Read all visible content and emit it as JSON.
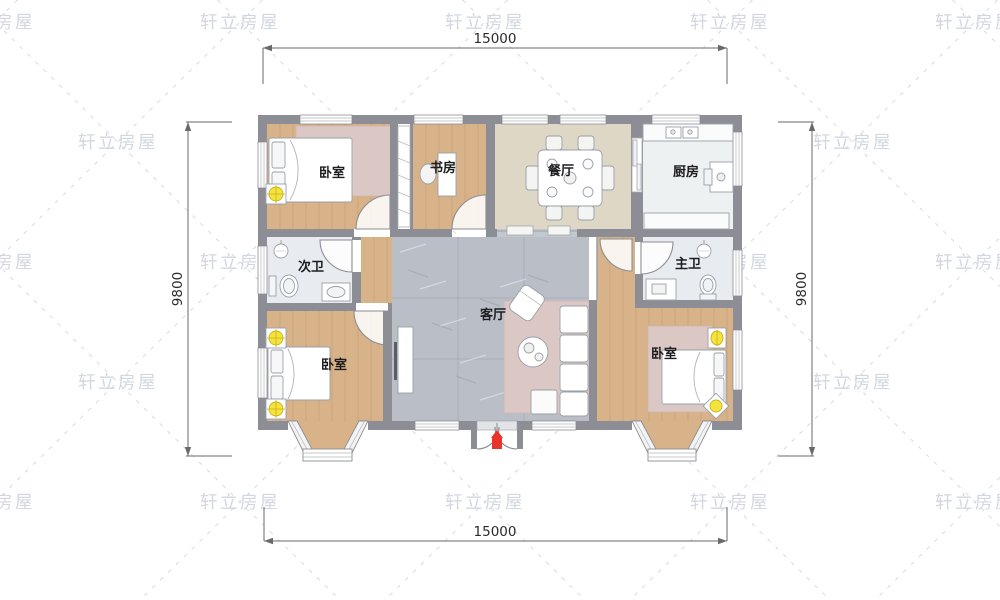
{
  "watermark": {
    "text": "轩立房屋",
    "color": "#c9d2dd"
  },
  "dimensions": {
    "top": "15000",
    "bottom": "15000",
    "left": "9800",
    "right": "9800"
  },
  "rooms": {
    "bedroom_top_left": {
      "label": "卧室"
    },
    "study": {
      "label": "书房"
    },
    "dining": {
      "label": "餐厅"
    },
    "kitchen": {
      "label": "厨房"
    },
    "bath_secondary": {
      "label": "次卫"
    },
    "bath_master": {
      "label": "主卫"
    },
    "living": {
      "label": "客厅"
    },
    "bedroom_bottom_left": {
      "label": "卧室"
    },
    "bedroom_bottom_right": {
      "label": "卧室"
    }
  },
  "colors": {
    "wall": "#8d8d95",
    "wood_floor": "#d8b289",
    "dining_floor": "#ded7c5",
    "kitchen_floor": "#eef1f2",
    "bath_floor": "#e8ecf1",
    "living_floor": "#b9bec7",
    "rug": "#dbc8c4",
    "lamp_yellow": "#f5e33d",
    "entrance_marker_red": "#e8342a"
  }
}
